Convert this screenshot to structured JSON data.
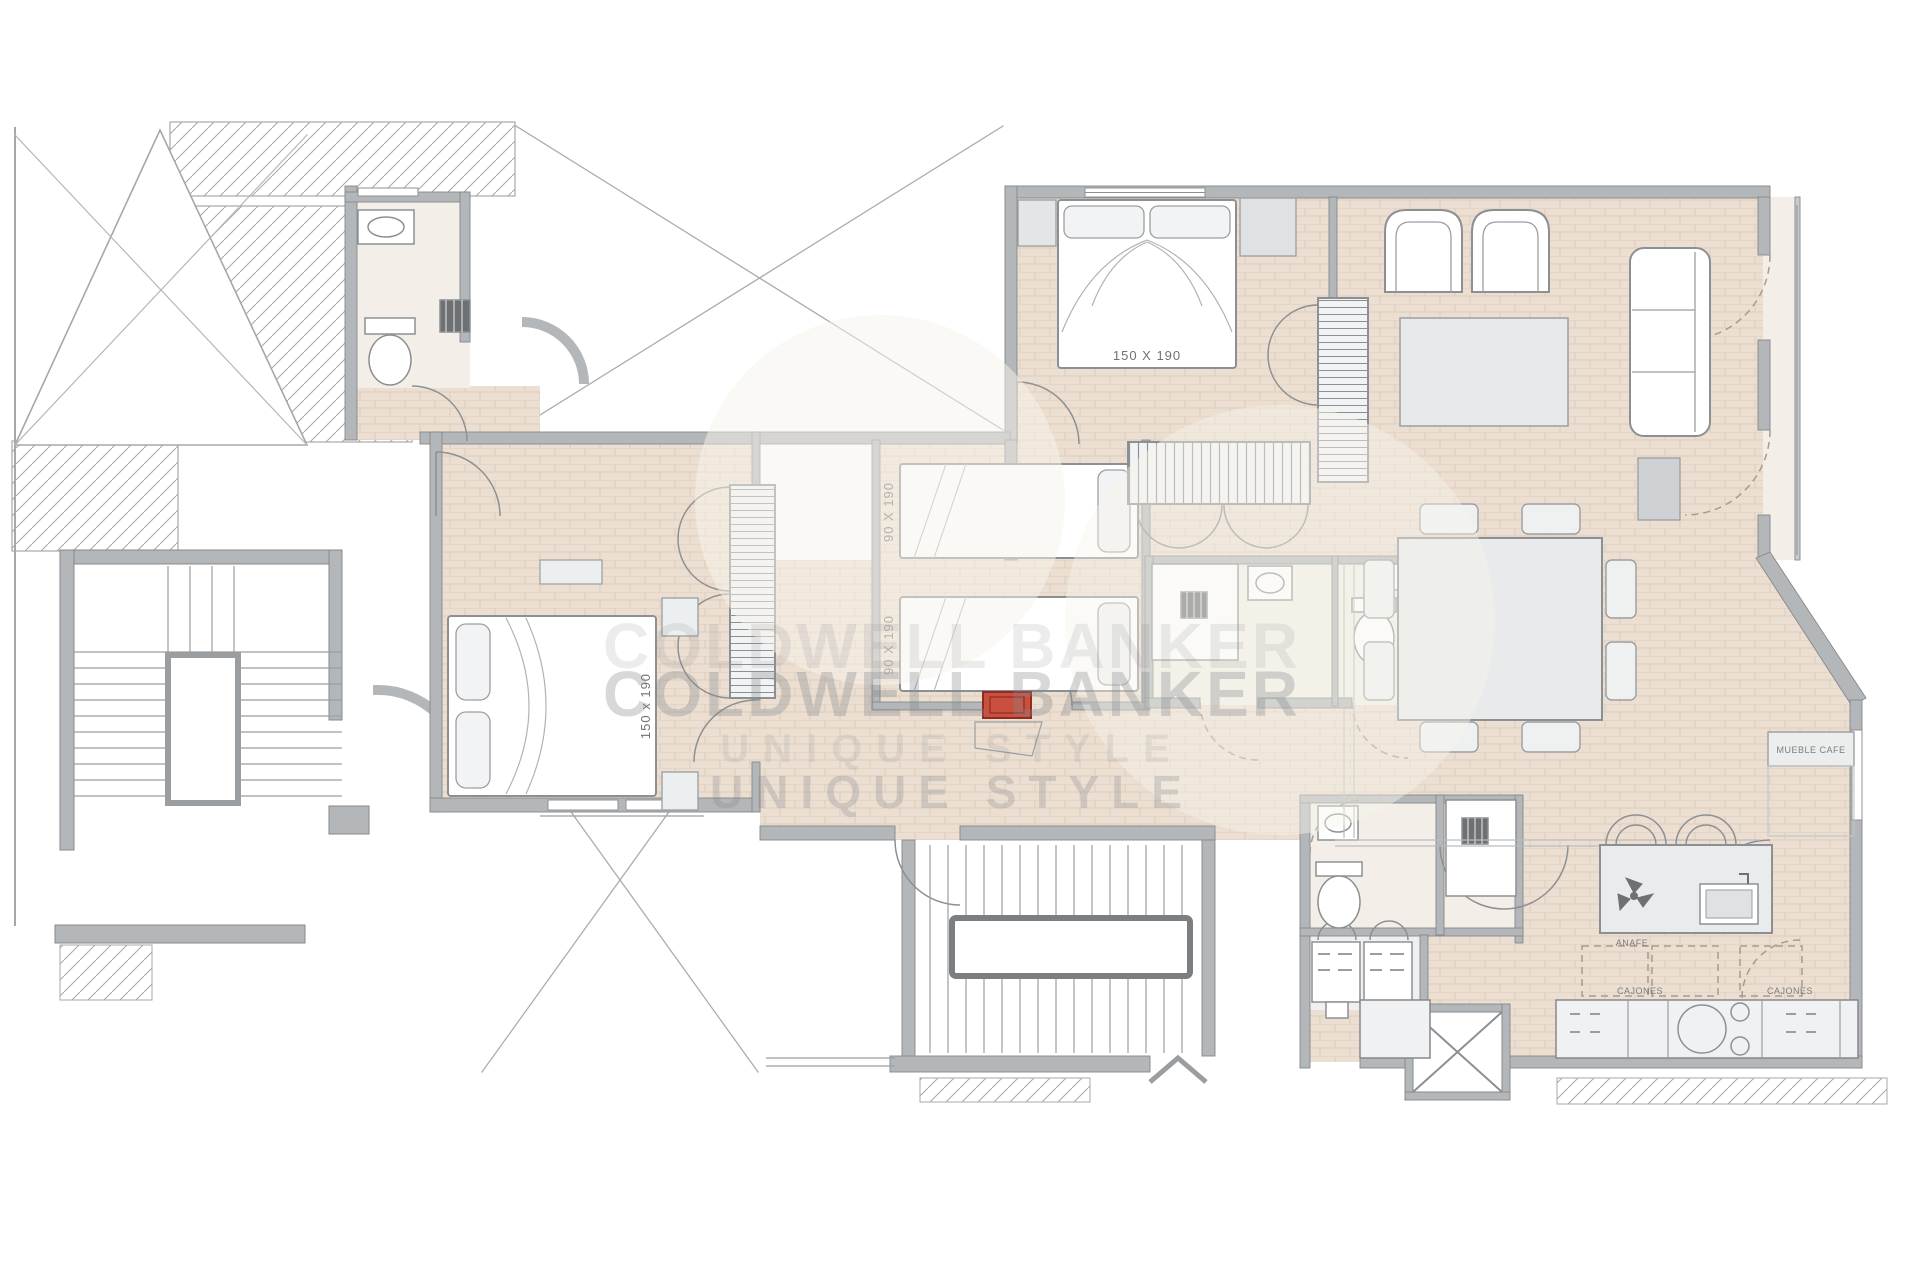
{
  "plan": {
    "title": "apartment-floor-plan",
    "watermark": {
      "line1": "COLDWELL BANKER",
      "line1_ghost": "COLDWELL BANKER",
      "line2": "UNIQUE STYLE",
      "line2_ghost": "UNIQUE STYLE"
    },
    "labels": {
      "master_bed_size": "150 X 190",
      "left_bed_size": "150 x 190",
      "single_bed_top_size": "90 X 190",
      "single_bed_bottom_size": "90 X 190",
      "kitchen_drawers_left": "CAJONES",
      "kitchen_drawers_right": "CAJONES",
      "kitchen_hob": "ANAFE",
      "coffee_cabinet": "MUEBLE CAFE"
    },
    "colors": {
      "floor": "#ecdfd2",
      "floor_line": "#d9c7b2",
      "bath_floor": "#f3efe8",
      "wall": "#b4b7b9",
      "wall_dark": "#85888b",
      "line": "#8d9093",
      "furniture": "#e9eaeb",
      "accent_red": "#c9503f",
      "hatch": "#a8acaf",
      "watermark": "#83888d",
      "dashed_door": "#a89a8c"
    }
  }
}
